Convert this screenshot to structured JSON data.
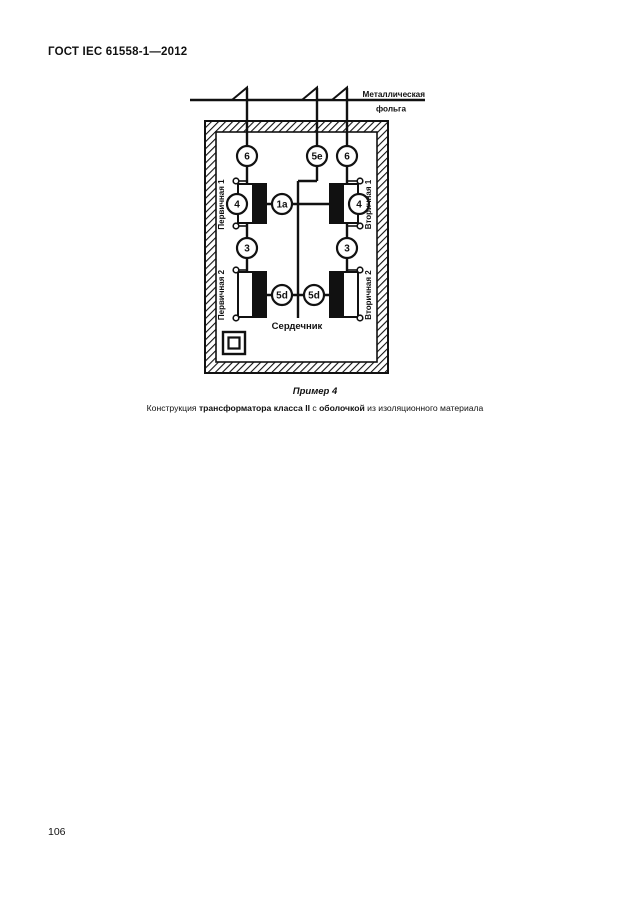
{
  "page": {
    "header": "ГОСТ IEC 61558-1—2012",
    "page_number": "106"
  },
  "figure": {
    "foil_label_line1": "Металлическая",
    "foil_label_line2": "фольга",
    "core_label": "Сердечник",
    "windings": {
      "primary1": "Первичная 1",
      "primary2": "Первичная 2",
      "secondary1": "Вторичная 1",
      "secondary2": "Вторичная 2"
    },
    "markers": {
      "top_left": "6",
      "top_center": "5e",
      "top_right": "6",
      "win1_left": "4",
      "center": "1a",
      "win1_right": "4",
      "mid_left": "3",
      "mid_right": "3",
      "bot_left": "5d",
      "bot_right": "5d"
    },
    "class2_symbol": "double-square"
  },
  "caption": {
    "example": "Пример 4",
    "parts": [
      {
        "text": "Конструкция ",
        "bold": false
      },
      {
        "text": "трансформатора класса II",
        "bold": true
      },
      {
        "text": " с ",
        "bold": false
      },
      {
        "text": "оболочкой",
        "bold": true
      },
      {
        "text": " из изоляционного материала",
        "bold": false
      }
    ]
  },
  "colors": {
    "ink": "#111111",
    "paper": "#ffffff"
  }
}
